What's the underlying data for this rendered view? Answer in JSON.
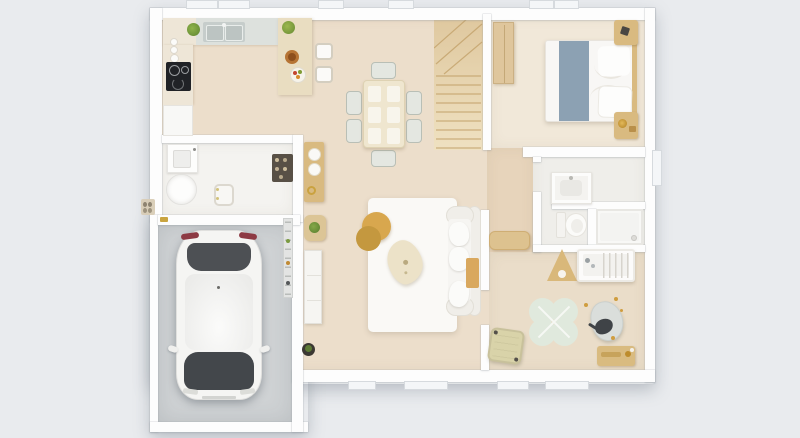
{
  "meta": {
    "view": "top-down-3d-rendered-floor-plan",
    "subject": "single-floor house with attached garage",
    "visible_text": "none"
  },
  "palette": {
    "bg": "#e9ebee",
    "wall": "#fdfdfd",
    "wood": "#ecdecb",
    "bedroom_floor": "#f1e8d9",
    "hall_floor": "#e7d4bb",
    "kids_floor": "#eaddc9",
    "utility_floor": "#f4f3f0",
    "bath_floor": "#efeeea",
    "shower_floor": "#f8f8f6",
    "garage_floor": "#cfd2d4",
    "counter": "#eee6d7",
    "counter_gray": "#dde1dd",
    "sink_gray": "#c6cdcb",
    "cooktop": "#202226",
    "tan": "#d9ba80",
    "tan_deep": "#caa45c",
    "mustard": "#d8a74e",
    "mustard_dark": "#c4983f",
    "runner_blue": "#8ca1b3",
    "plant_green": "#709c3c",
    "playmat_green": "#e0e9dd",
    "white_soft": "#f7f6f3",
    "gray_soft": "#dadedb",
    "dark": "#3f4347",
    "rug": "#faf9f6",
    "stair": "#ead8b6",
    "stair_line": "#c3a26b",
    "car_body": "#f5f5f3",
    "car_glass": "#43474b",
    "tail_light": "#8d3a44"
  },
  "rooms": [
    {
      "name": "kitchen",
      "items": [
        "l-shaped-counter",
        "double-sink",
        "cooktop",
        "fridge-cabinet",
        "peninsula-counter",
        "bar-stool",
        "bar-stool",
        "potted-plant",
        "potted-plant",
        "serving-bowl",
        "fruit-plate",
        "spice-jars"
      ]
    },
    {
      "name": "dining-area",
      "items": [
        "dining-table",
        "placemats-x6",
        "dining-chairs-x6"
      ]
    },
    {
      "name": "living-room",
      "items": [
        "area-rug",
        "sofa",
        "throw-blanket",
        "round-coffee-table-pair",
        "organic-coffee-table",
        "tv-sideboard",
        "plant-stool",
        "floor-plant"
      ]
    },
    {
      "name": "entry",
      "items": [
        "console-table",
        "decor-bowls",
        "shoe-rack",
        "exterior-doormat-with-shoes"
      ]
    },
    {
      "name": "staircase",
      "items": [
        "winder-staircase"
      ]
    },
    {
      "name": "bedroom",
      "items": [
        "double-bed",
        "bed-runner",
        "pillows-x2",
        "wardrobe",
        "nightstand-x2",
        "table-lamp",
        "clock"
      ]
    },
    {
      "name": "hallway",
      "items": [
        "low-cabinet"
      ]
    },
    {
      "name": "bathroom",
      "items": [
        "vanity-with-sink",
        "toilet",
        "walk-in-shower"
      ]
    },
    {
      "name": "kids-room",
      "items": [
        "crib",
        "play-teepee",
        "clover-play-mat",
        "beanbag",
        "plush-elephant",
        "storage-basket",
        "toy-bench"
      ]
    },
    {
      "name": "utility-room",
      "items": [
        "washing-machine",
        "laundry-basin",
        "chair"
      ]
    },
    {
      "name": "garage",
      "items": [
        "white-car-top-view",
        "wall-shelf-rack"
      ]
    }
  ],
  "windows": {
    "top_wall": 4,
    "right_wall": 1,
    "bottom_wall": 4
  }
}
